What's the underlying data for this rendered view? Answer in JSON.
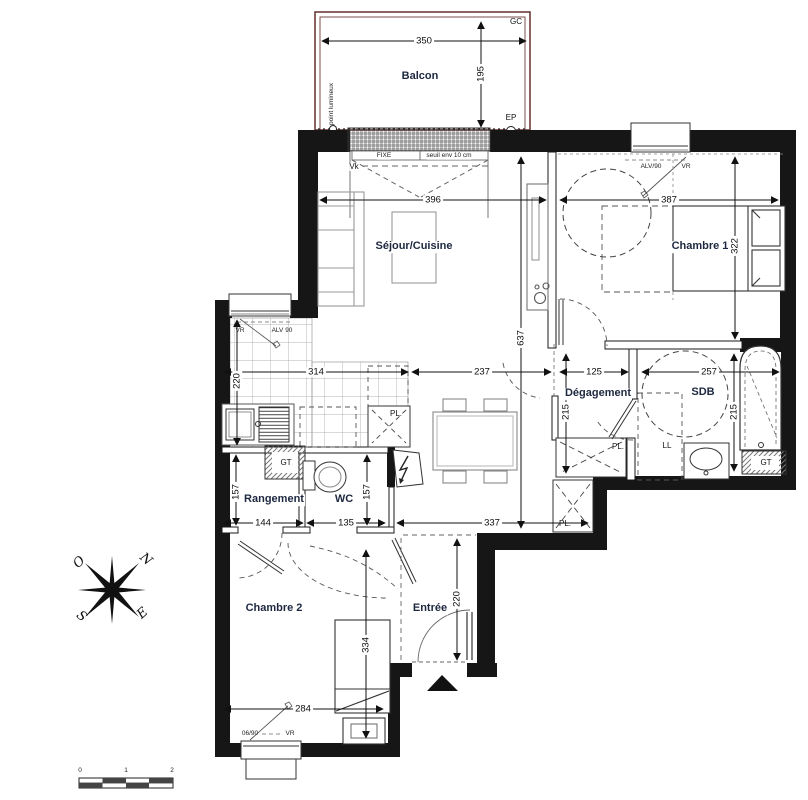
{
  "rooms": {
    "balcon": "Balcon",
    "sejour": "Séjour/Cuisine",
    "chambre1": "Chambre 1",
    "degagement": "Dégagement",
    "sdb": "SDB",
    "rangement": "Rangement",
    "wc": "WC",
    "chambre2": "Chambre 2",
    "entree": "Entrée"
  },
  "dims": {
    "balcony_width": "350",
    "balcony_depth": "195",
    "sejour_width": "396",
    "chambre1_width": "387",
    "chambre1_height": "322",
    "sejour_height": "637",
    "kitchen_height": "220",
    "kitchen_width": "314",
    "hall_width": "237",
    "degagement_width": "125",
    "sdb_width": "257",
    "degagement_height": "215",
    "sdb_height": "215",
    "rangement_width": "144",
    "rangement_height": "157",
    "wc_width": "135",
    "wc_height": "157",
    "hall_length": "337",
    "entree_height": "220",
    "chambre2_width": "284",
    "chambre2_height": "334"
  },
  "annotations": {
    "gc": "GC",
    "ep": "EP",
    "point_lumineux": "point lumineux",
    "fixe": "FIXE",
    "seuil": "seuil env 10 cm",
    "vk": "Vk",
    "vr_kitchen": "VR",
    "alv_kitchen": "ALV 90",
    "alv_chambre1": "ALV/90",
    "vr_chambre1": "VR",
    "pl_kitchen": "PL.",
    "pl_degagement": "PL.",
    "pl_entree": "PL.",
    "gt_kitchen": "GT",
    "gt_sdb": "GT",
    "ll": "LL",
    "window_chambre2": "06/90",
    "vr_chambre2": "VR"
  },
  "compass": {
    "north": "N",
    "south": "S",
    "east": "E",
    "west": "O"
  },
  "scale_bar": {
    "t0": "0",
    "t1": "1",
    "t2": "2"
  }
}
